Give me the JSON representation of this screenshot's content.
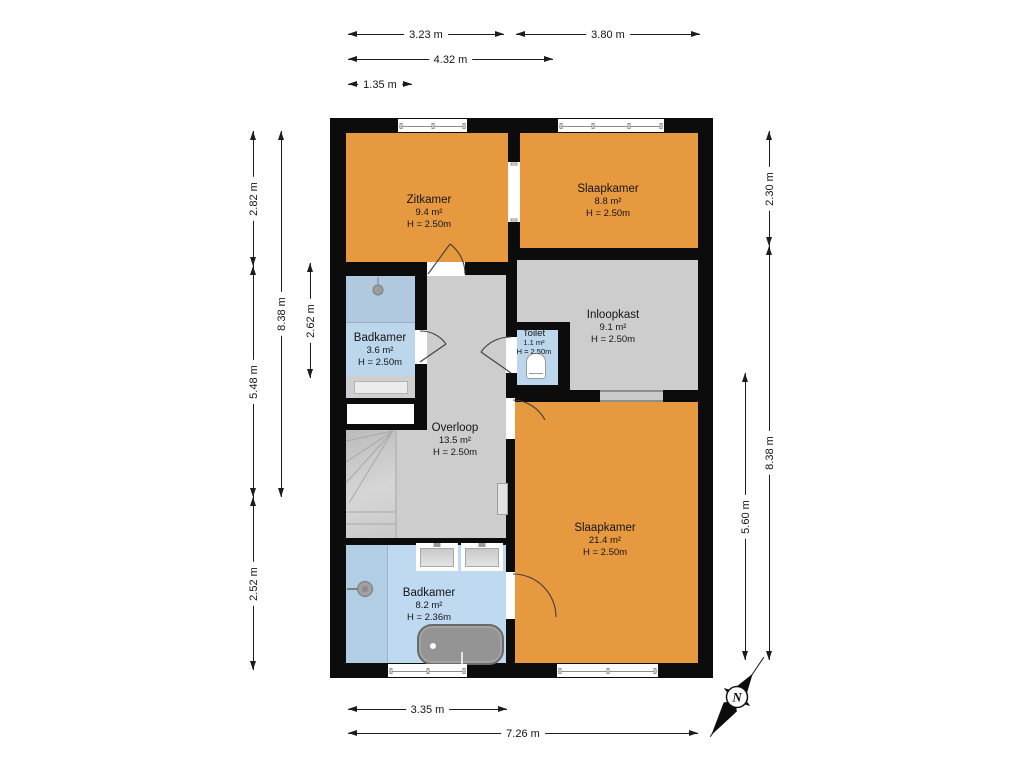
{
  "floorplan": {
    "rooms": [
      {
        "name": "Zitkamer",
        "area": "9.4 m²",
        "height": "H = 2.50m"
      },
      {
        "name": "Slaapkamer",
        "area": "8.8 m²",
        "height": "H = 2.50m"
      },
      {
        "name": "Badkamer",
        "area": "3.6 m²",
        "height": "H = 2.50m"
      },
      {
        "name": "Toilet",
        "area": "1.1 m²",
        "height": "H = 2.50m"
      },
      {
        "name": "Inloopkast",
        "area": "9.1 m²",
        "height": "H = 2.50m"
      },
      {
        "name": "Overloop",
        "area": "13.5 m²",
        "height": "H = 2.50m"
      },
      {
        "name": "Slaapkamer",
        "area": "21.4 m²",
        "height": "H = 2.50m"
      },
      {
        "name": "Badkamer",
        "area": "8.2 m²",
        "height": "H = 2.36m"
      }
    ],
    "dimensions": {
      "top": [
        "3.23 m",
        "3.80 m",
        "4.32 m",
        "1.35 m"
      ],
      "bottom": [
        "3.35 m",
        "7.26 m"
      ],
      "left": [
        "2.82 m",
        "5.48 m",
        "2.52 m",
        "8.38 m",
        "2.62 m"
      ],
      "right": [
        "2.30 m",
        "8.38 m",
        "5.60 m"
      ]
    },
    "compass": {
      "label": "N"
    },
    "colors": {
      "wall": "#0c0c0c",
      "dry_room": "#e7993f",
      "circulation": "#cdcdcd",
      "wet_room": "#bcd6ec"
    }
  }
}
